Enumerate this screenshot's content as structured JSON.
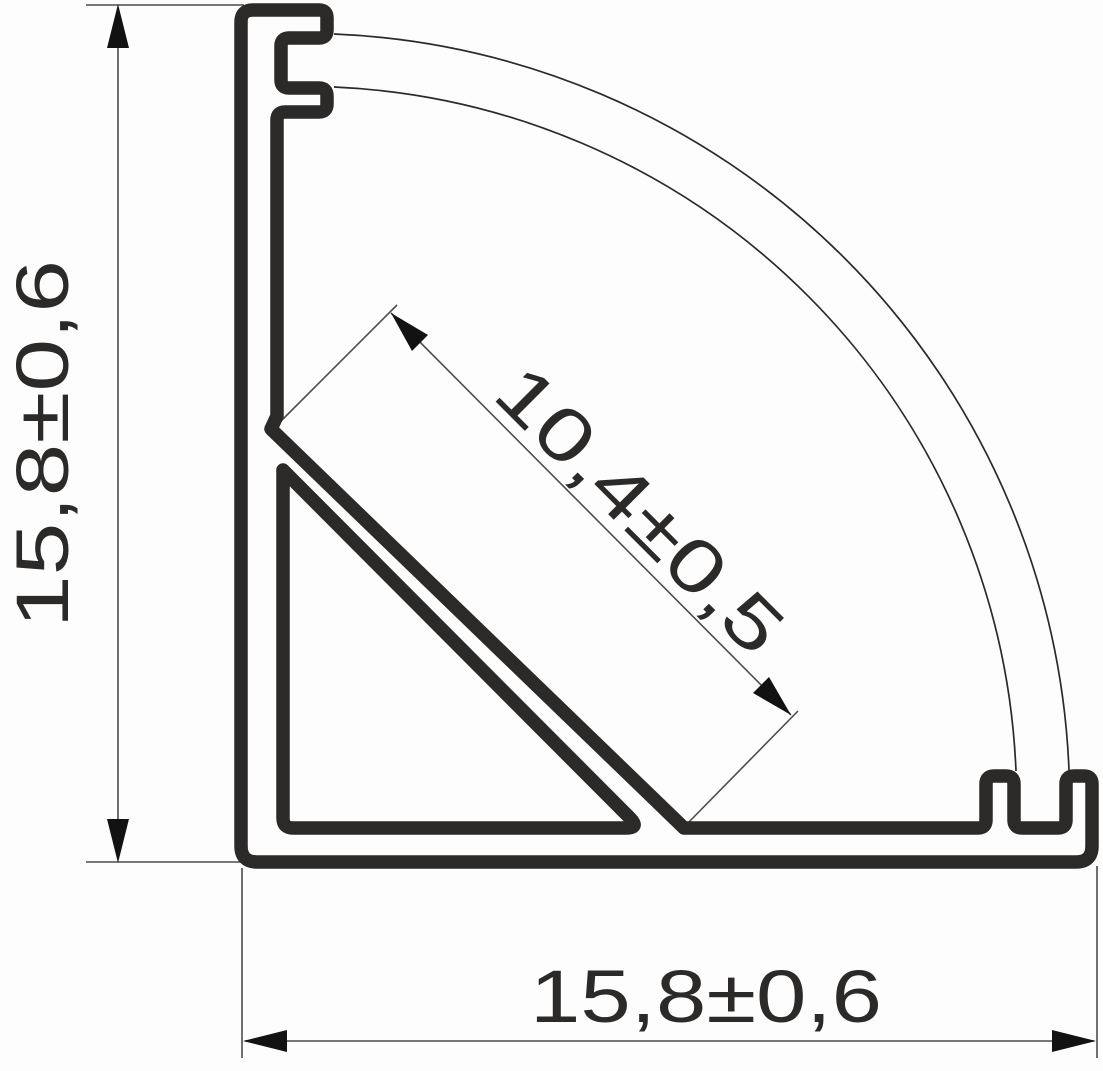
{
  "drawing": {
    "background_color": "#fdfdfd",
    "profile_stroke_color": "#2b2a29",
    "thin_line_color": "#4d4d4d",
    "arrow_color": "#121212",
    "dimensions": {
      "height": {
        "label": "15,8±0,6"
      },
      "width": {
        "label": "15,8±0,6"
      },
      "diagonal": {
        "label": "10,4±0,5"
      }
    }
  }
}
